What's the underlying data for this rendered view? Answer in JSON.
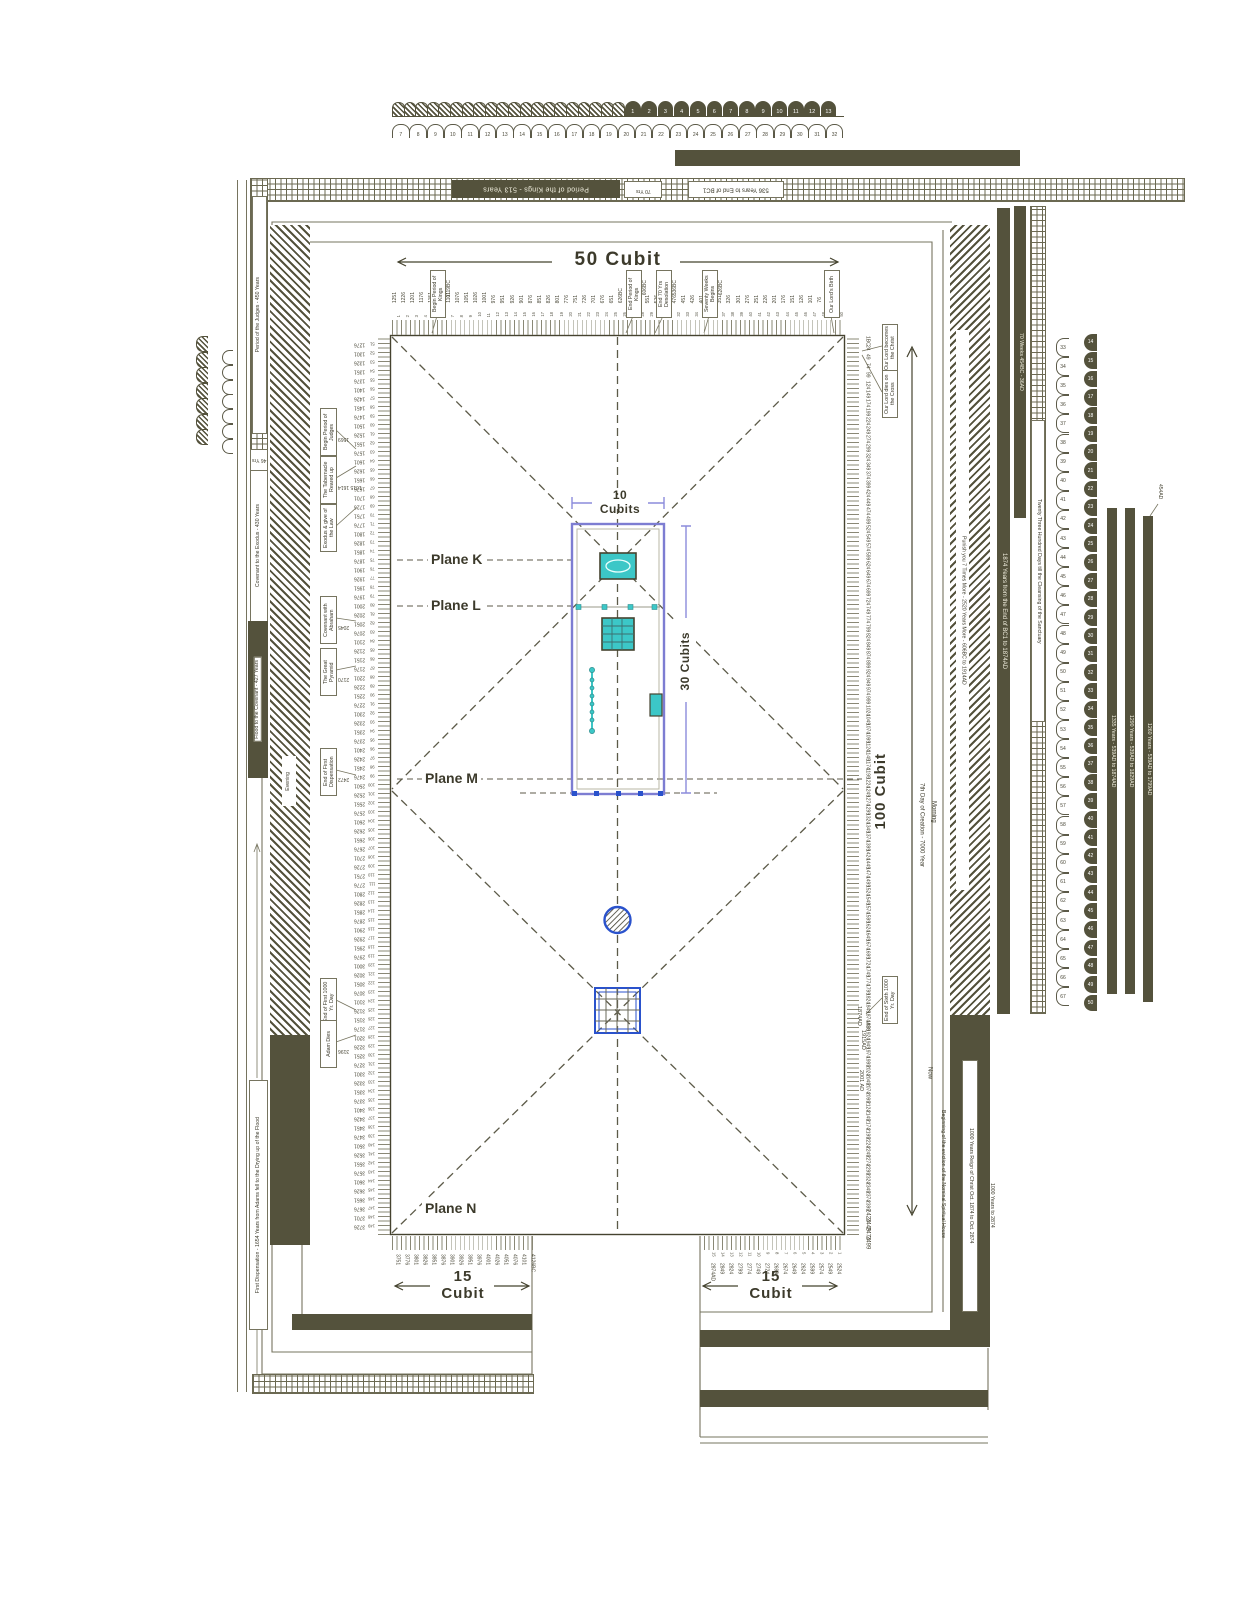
{
  "colors": {
    "olive": "#54523c",
    "teal": "#3cc7c7",
    "blue": "#2a52cc",
    "periwinkle": "#8b8bdc",
    "line": "#76745f"
  },
  "dimensions": {
    "top": "50  Cubit",
    "right": "100  Cubit",
    "bottom_left": "15 Cubit",
    "bottom_right": "15 Cubit",
    "tabernacle_width": "10 Cubits",
    "tabernacle_length": "30 Cubits"
  },
  "planes": {
    "k": "Plane K",
    "l": "Plane L",
    "m": "Plane M",
    "n": "Plane N"
  },
  "top_bars": {
    "kings": "Period of the Kings  -  513 Years",
    "seventy_yrs": "70 Yrs",
    "bc536": "536 Years to End of BC1"
  },
  "left_bars": {
    "judges": "Period of the Judges  -  450 Years",
    "yrs46": "46 Yrs",
    "covenant_exodus": "Covenant to the Exodus   -   430 Years",
    "flood_covenant": "Flood to the Covenant  -  427 Years",
    "first_dispensation": "First Dispensation  -  1654 Years from Adams fell to the Drying up of the Flood",
    "evening": "Evening"
  },
  "right_bars": {
    "punish": "Punish you 7 Times More - 2520 Years More - 606BC to 1914AD",
    "yrs1874": "1874 Years from  the End of BC1 to 1874AD",
    "weeks70": "70 Weeks 454BC - 36AD",
    "days2300": "Twenty Three Hundred Days till the Cleansing of the Sanctuary",
    "yrs1335": "1335 Years  -  539AD to 1874AD",
    "yrs1290": "1290 Years  -  539AD to 1829AD",
    "yrs1260": "1260 Years  -  539AD to 1799AD",
    "reign1000": "1000 Years Reign of Christ Oct. 1874 to Oct. 2874",
    "eviction": "Beginning of the eviction of the Nominal Spiritual House",
    "to2874": "1000 Years to 2874",
    "ad454": "454AD",
    "seventh_day": "7th Day of Creation - 7000 Year",
    "morning": "Morning",
    "now": "Now"
  },
  "annotations": {
    "top": [
      {
        "text": "Begin Period of Kings",
        "note": "1119BC",
        "x": 430
      },
      {
        "text": "End Period of Kings",
        "note": "606BC",
        "x": 626
      },
      {
        "text": "End 70 Yrs Desolation",
        "note": "536BC",
        "x": 656
      },
      {
        "text": "Seventy Weeks Begins",
        "note": "626BC",
        "x": 702
      },
      {
        "text": "Our Lord's Birth",
        "note": "",
        "x": 824
      }
    ],
    "left": [
      {
        "text": "Begin Period of Judges",
        "note": "1569",
        "y": 408
      },
      {
        "text": "The Tabernacle Reared up",
        "note": "1615 1614",
        "y": 456
      },
      {
        "text": "Exodus & give of the Law",
        "note": "",
        "y": 504
      },
      {
        "text": "Covenant with Abraham",
        "note": "2045",
        "y": 596
      },
      {
        "text": "The Great Pyramid",
        "note": "2170",
        "y": 648
      },
      {
        "text": "End of First Dispensation",
        "note": "2472",
        "y": 748
      },
      {
        "text": "End of First 1000 Yr. Day",
        "note": "",
        "y": 978
      },
      {
        "text": "Adam Dies",
        "note": "3196",
        "y": 1020
      }
    ],
    "right": [
      {
        "text": "Our Lord becomes the Christ",
        "y": 324
      },
      {
        "text": "Our Lord dies on the Cross",
        "y": 370
      },
      {
        "text": "End of Sixth 1000 Yr. Day",
        "y": 976
      }
    ],
    "right_extra": [
      {
        "text": "1874AD",
        "x": 856,
        "y": 1006
      },
      {
        "text": "1915AD",
        "x": 860,
        "y": 1030
      },
      {
        "text": "2001 AD",
        "x": 858,
        "y": 1070
      }
    ]
  },
  "scales": {
    "top": {
      "cubits_from": 1,
      "years": [
        1251,
        1226,
        1201,
        1176,
        1151,
        1126,
        1101,
        1076,
        1051,
        1026,
        1001,
        976,
        951,
        926,
        901,
        876,
        851,
        826,
        801,
        776,
        751,
        726,
        701,
        676,
        651,
        "626BC",
        601,
        576,
        551,
        526,
        501,
        476,
        451,
        426,
        401,
        376,
        351,
        326,
        301,
        276,
        251,
        226,
        201,
        176,
        151,
        126,
        101,
        76,
        51,
        26
      ]
    },
    "left": {
      "cubits_from": 51,
      "years": [
        1276,
        1301,
        1326,
        1351,
        1376,
        1401,
        1426,
        1451,
        1476,
        1501,
        1526,
        1551,
        1576,
        1601,
        1626,
        1651,
        1676,
        1701,
        1726,
        1751,
        1776,
        1801,
        1826,
        1851,
        1876,
        1901,
        1926,
        1951,
        1976,
        2001,
        2026,
        2051,
        2076,
        2101,
        2126,
        2151,
        2176,
        2201,
        2226,
        2251,
        2276,
        2301,
        2326,
        2351,
        2376,
        2401,
        2426,
        2451,
        2476,
        2501,
        2526,
        2551,
        2576,
        2601,
        2626,
        2651,
        2676,
        2701,
        2726,
        2751,
        2776,
        2801,
        2826,
        2851,
        2876,
        2901,
        2926,
        2951,
        2976,
        3001,
        3026,
        3051,
        3076,
        3101,
        3126,
        3151,
        3176,
        3201,
        3226,
        3251,
        3276,
        3301,
        3326,
        3351,
        3376,
        3401,
        3426,
        3451,
        3476,
        3501,
        3526,
        3551,
        3576,
        3601,
        3626,
        3651,
        3676,
        3701,
        3726
      ]
    },
    "right": {
      "years": [
        "1BC",
        24,
        49,
        74,
        99,
        124,
        149,
        174,
        199,
        224,
        249,
        274,
        299,
        324,
        349,
        374,
        399,
        424,
        449,
        474,
        499,
        524,
        549,
        574,
        599,
        624,
        649,
        674,
        699,
        724,
        749,
        774,
        799,
        824,
        849,
        874,
        899,
        924,
        949,
        974,
        999,
        1024,
        1049,
        1074,
        1099,
        1124,
        1149,
        1174,
        1199,
        1224,
        1249,
        1274,
        1299,
        1324,
        1349,
        1374,
        1399,
        1424,
        1449,
        1474,
        1499,
        1524,
        1549,
        1574,
        1599,
        1624,
        1649,
        1674,
        1699,
        1724,
        1749,
        1774,
        1799,
        1824,
        1849,
        "1874AD",
        1899,
        1924,
        1949,
        1974,
        1999,
        2024,
        2049,
        2074,
        2099,
        2124,
        2149,
        2174,
        2199,
        2224,
        2249,
        2274,
        2299,
        2324,
        2349,
        2374,
        2399,
        2424,
        2449,
        2474,
        2499
      ]
    },
    "bottom_left": {
      "years": [
        3751,
        3776,
        3801,
        3826,
        3851,
        3876,
        3901,
        3926,
        3951,
        3976,
        4001,
        4026,
        4051,
        4076,
        4101,
        "4126BC"
      ]
    },
    "bottom_right": {
      "cubits": [
        15,
        14,
        13,
        12,
        11,
        10,
        9,
        8,
        7,
        6,
        5,
        4,
        3,
        2,
        1
      ],
      "years": [
        "2874AD",
        2849,
        2824,
        2799,
        2774,
        2749,
        2724,
        2699,
        2674,
        2649,
        2624,
        2599,
        2574,
        2549,
        2524
      ]
    }
  },
  "scallops": {
    "top_hatched_count": 20,
    "top_dark": {
      "from": 1,
      "to": 13
    },
    "top_arcs": {
      "from": 7,
      "to": 32
    },
    "right_arcs": {
      "from": 33,
      "to": 67
    },
    "right_dark": {
      "from": 14,
      "to": 50
    },
    "mini_count": 7
  }
}
